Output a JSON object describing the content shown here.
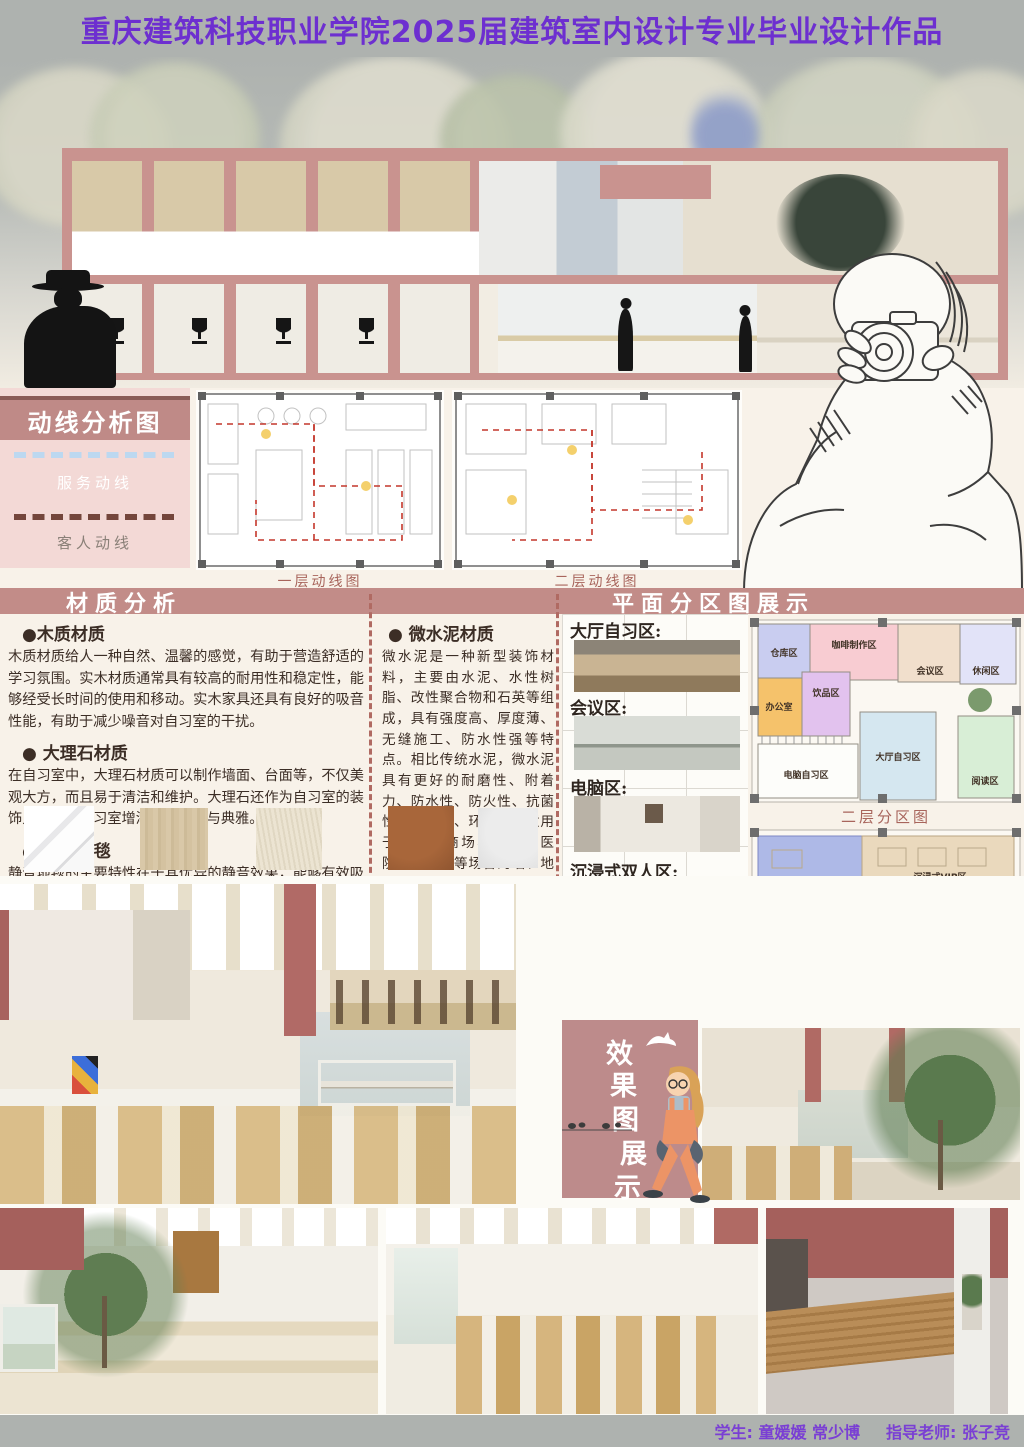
{
  "title": "重庆建筑科技职业学院2025届建筑室内设计专业毕业设计作品",
  "circulation": {
    "title": "动线分析图",
    "legend": [
      {
        "label": "服务动线",
        "color": "#bcd8f0"
      },
      {
        "label": "客人动线",
        "color": "#74463c"
      }
    ],
    "caption_floor1": "一层动线图",
    "caption_floor2": "二层动线图"
  },
  "section_headers": {
    "materials": "材质分析",
    "zoning": "平面分区图展示"
  },
  "materials": {
    "items": [
      {
        "name": "●木质材质",
        "desc": "木质材质给人一种自然、温馨的感觉，有助于营造舒适的学习氛围。实木材质通常具有较高的耐用性和稳定性，能够经受长时间的使用和移动。实木家具还具有良好的吸音性能，有助于减少噪音对自习室的干扰。"
      },
      {
        "name": "● 大理石材质",
        "desc": "在自习室中，大理石材质可以制作墙面、台面等，不仅美观大方，而且易于清洁和维护。大理石还作为自习室的装饰点缀，为自习室增添一份高贵与典雅。"
      },
      {
        "name": "● 静音地毯",
        "desc": "静音地毯的主要特性在于其优异的静音效果，能够有效吸收和减少噪音，为自习室提供一个更加安静的学习环境。"
      },
      {
        "name": "● 微水泥材质",
        "desc": "微水泥是一种新型装饰材料，主要由水泥、水性树脂、改性聚合物和石英等组成，具有强度高、厚度薄、无缝施工、防水性强等特点。相比传统水泥，微水泥具有更好的耐磨性、附着力、防水性、防火性、抗菌性、防滑性、环保性，适用于家庭、商场、办公、医院、图书馆等场合的墙、地面装修"
      }
    ]
  },
  "zoning": {
    "area_labels": [
      "大厅自习区:",
      "会议区:",
      "电脑区:",
      "沉浸式双人区:",
      "沉浸式VIP区"
    ],
    "floor2_caption": "二层分区图",
    "floor1_zones": [
      {
        "label": "仓库区",
        "color": "#c9cdf0"
      },
      {
        "label": "咖啡制作区",
        "color": "#f8ccd2"
      },
      {
        "label": "会议区",
        "color": "#f1dfcc"
      },
      {
        "label": "休闲区",
        "color": "#e2e3f8"
      },
      {
        "label": "办公室",
        "color": "#f5c26b"
      },
      {
        "label": "饮品区",
        "color": "#e2c2ee"
      },
      {
        "label": "电脑自习区",
        "color": "#fdfdfa"
      },
      {
        "label": "大厅自习区",
        "color": "#d5e7f0"
      },
      {
        "label": "阅读区",
        "color": "#d8eed6"
      }
    ],
    "floor2_zones": [
      {
        "label": "沉浸式双人区",
        "color": "#aeb9e7"
      },
      {
        "label": "沉浸式VIP区",
        "color": "#ead9bd"
      },
      {
        "label": "沉浸式单人区",
        "color": "#f2d38b"
      }
    ]
  },
  "fx": {
    "chars": [
      "效",
      "果",
      "图",
      "展",
      "示"
    ]
  },
  "credits": {
    "students": "学生: 童媛媛 常少博",
    "advisor": "指导老师: 张子竞"
  }
}
